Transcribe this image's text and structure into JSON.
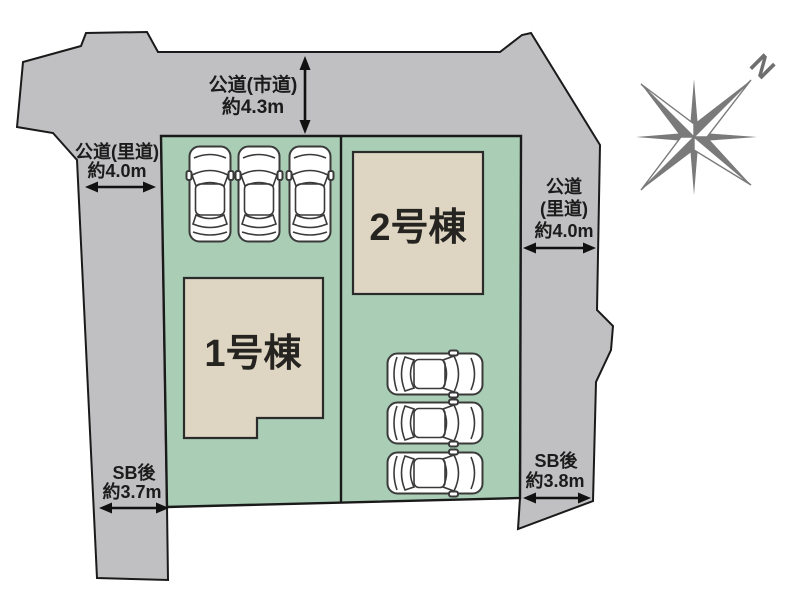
{
  "site_plan": {
    "roads": {
      "top": {
        "line1": "公道(市道)",
        "line2": "約4.3m"
      },
      "left": {
        "line1": "公道(里道)",
        "line2": "約4.0m"
      },
      "right": {
        "line1": "公道",
        "line2": "(里道)",
        "line3": "約4.0m"
      }
    },
    "setbacks": {
      "left": {
        "line1": "SB後",
        "line2": "約3.7m"
      },
      "right": {
        "line1": "SB後",
        "line2": "約3.8m"
      }
    },
    "buildings": [
      {
        "label": "1号棟"
      },
      {
        "label": "2号棟"
      }
    ],
    "parking": {
      "top_row_cars": 3,
      "right_column_cars": 3
    },
    "compass": {
      "north_label": "N"
    },
    "colors": {
      "road": "#c0bfc1",
      "lot": "#a9ceb5",
      "building": "#ded6c3",
      "outline": "#1a1a1a",
      "compass": "#7a7a7a"
    }
  }
}
